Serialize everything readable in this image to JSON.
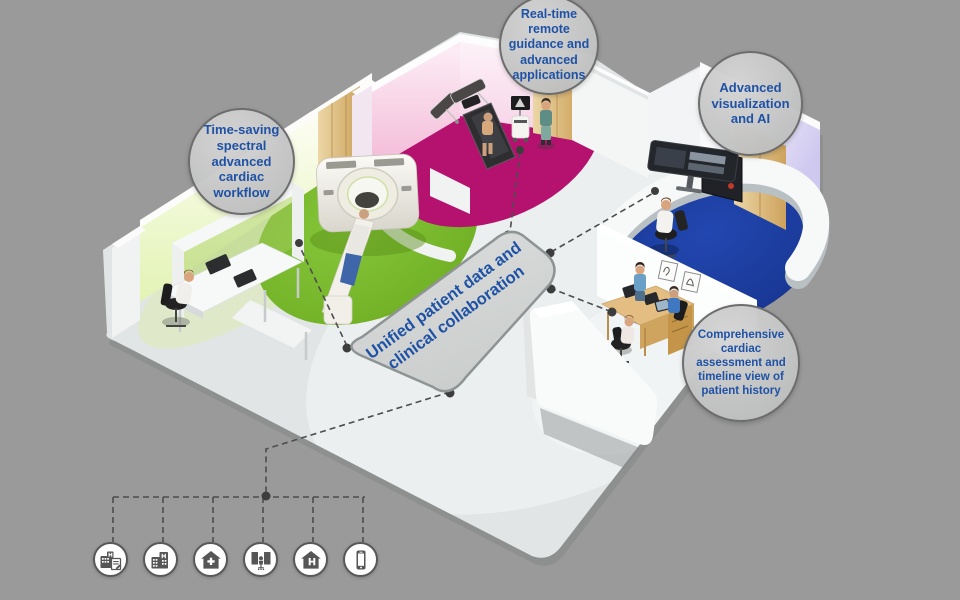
{
  "scene": {
    "background_color": "#9a9a9a",
    "description_labels_present": 5
  },
  "platform": {
    "line1": "Unified patient data and",
    "line2": "clinical collaboration"
  },
  "callouts": [
    {
      "id": "spectral-ct",
      "label": "Time-saving spectral advanced cardiac workflow"
    },
    {
      "id": "remote-guidance",
      "label": "Real-time remote guidance and advanced applications"
    },
    {
      "id": "advanced-visualization",
      "label": "Advanced visualization and AI"
    },
    {
      "id": "cardiac-assessment",
      "label": "Comprehensive cardiac assessment and timeline view of patient history"
    }
  ],
  "icons": [
    {
      "name": "hospital-report-icon"
    },
    {
      "name": "hospital-building-icon"
    },
    {
      "name": "clinic-home-plus-icon"
    },
    {
      "name": "imaging-workstation-icon"
    },
    {
      "name": "home-hospital-icon"
    },
    {
      "name": "mobile-device-icon"
    }
  ],
  "colors": {
    "accent_blue_text": "#1f52a5",
    "ct_room_floor_green": "#79b92c",
    "stress_room_floor_magenta": "#b5126f",
    "reading_room_floor_navy": "#1c3ea6",
    "wall_lime_glow": "#e7f5bc",
    "wall_pink_glow": "#f4c3dc",
    "wall_lavender_glow": "#cfc8ef",
    "wood_panel": "#dcb271",
    "platform_fill": "#d3d5d5",
    "bubble_fill": "#c6c7c7",
    "bubble_border": "#6d6d6d",
    "connector_line": "#4d4d4d",
    "floor_grey": "#e2e5e5"
  }
}
